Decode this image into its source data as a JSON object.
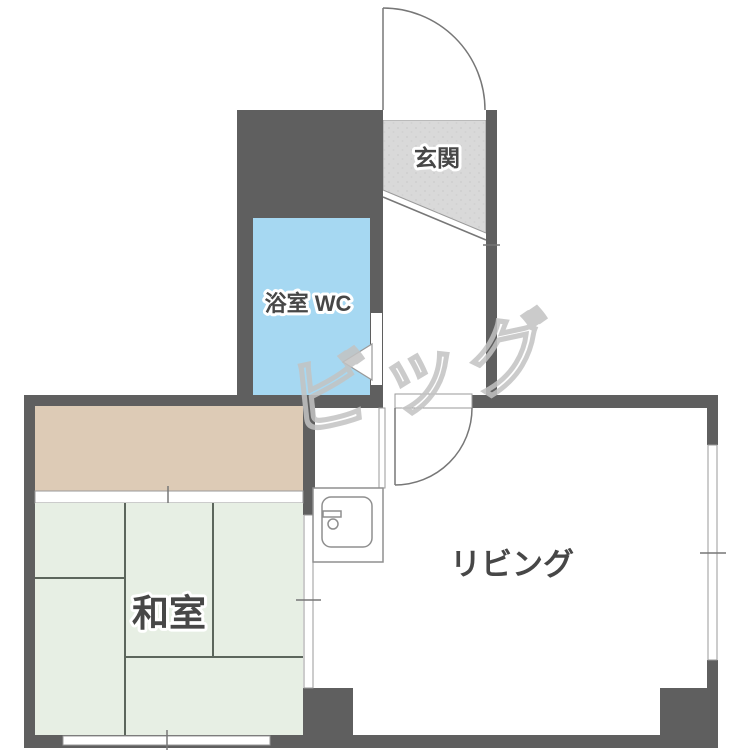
{
  "floorplan": {
    "type": "japanese-apartment-floorplan",
    "rooms": {
      "genkan": {
        "label": "玄関"
      },
      "bathroom": {
        "label": "浴室 WC"
      },
      "washitsu": {
        "label": "和室"
      },
      "living": {
        "label": "リビング"
      }
    },
    "fixtures": {
      "kitchen_sink": "kitchen-sink",
      "entry_door": "entry-door-swing",
      "living_door": "living-door-swing",
      "bath_door_arrow": "bath-door-arrow",
      "closet": "closet",
      "windows": [
        "right-window",
        "bottom-window",
        "washitsu-sliding-door",
        "closet-sliding-door"
      ]
    },
    "watermark": {
      "text": "ビッグ"
    },
    "colors": {
      "wall": "#5f5f5f",
      "bathroom": "#a6d8f2",
      "tatami": "#e7efe4",
      "closet": "#ddcbb6",
      "genkan": "#d9d9d9",
      "tatami_line": "#5c665c",
      "label": "#474747",
      "watermark": "#c3c3c3"
    }
  }
}
